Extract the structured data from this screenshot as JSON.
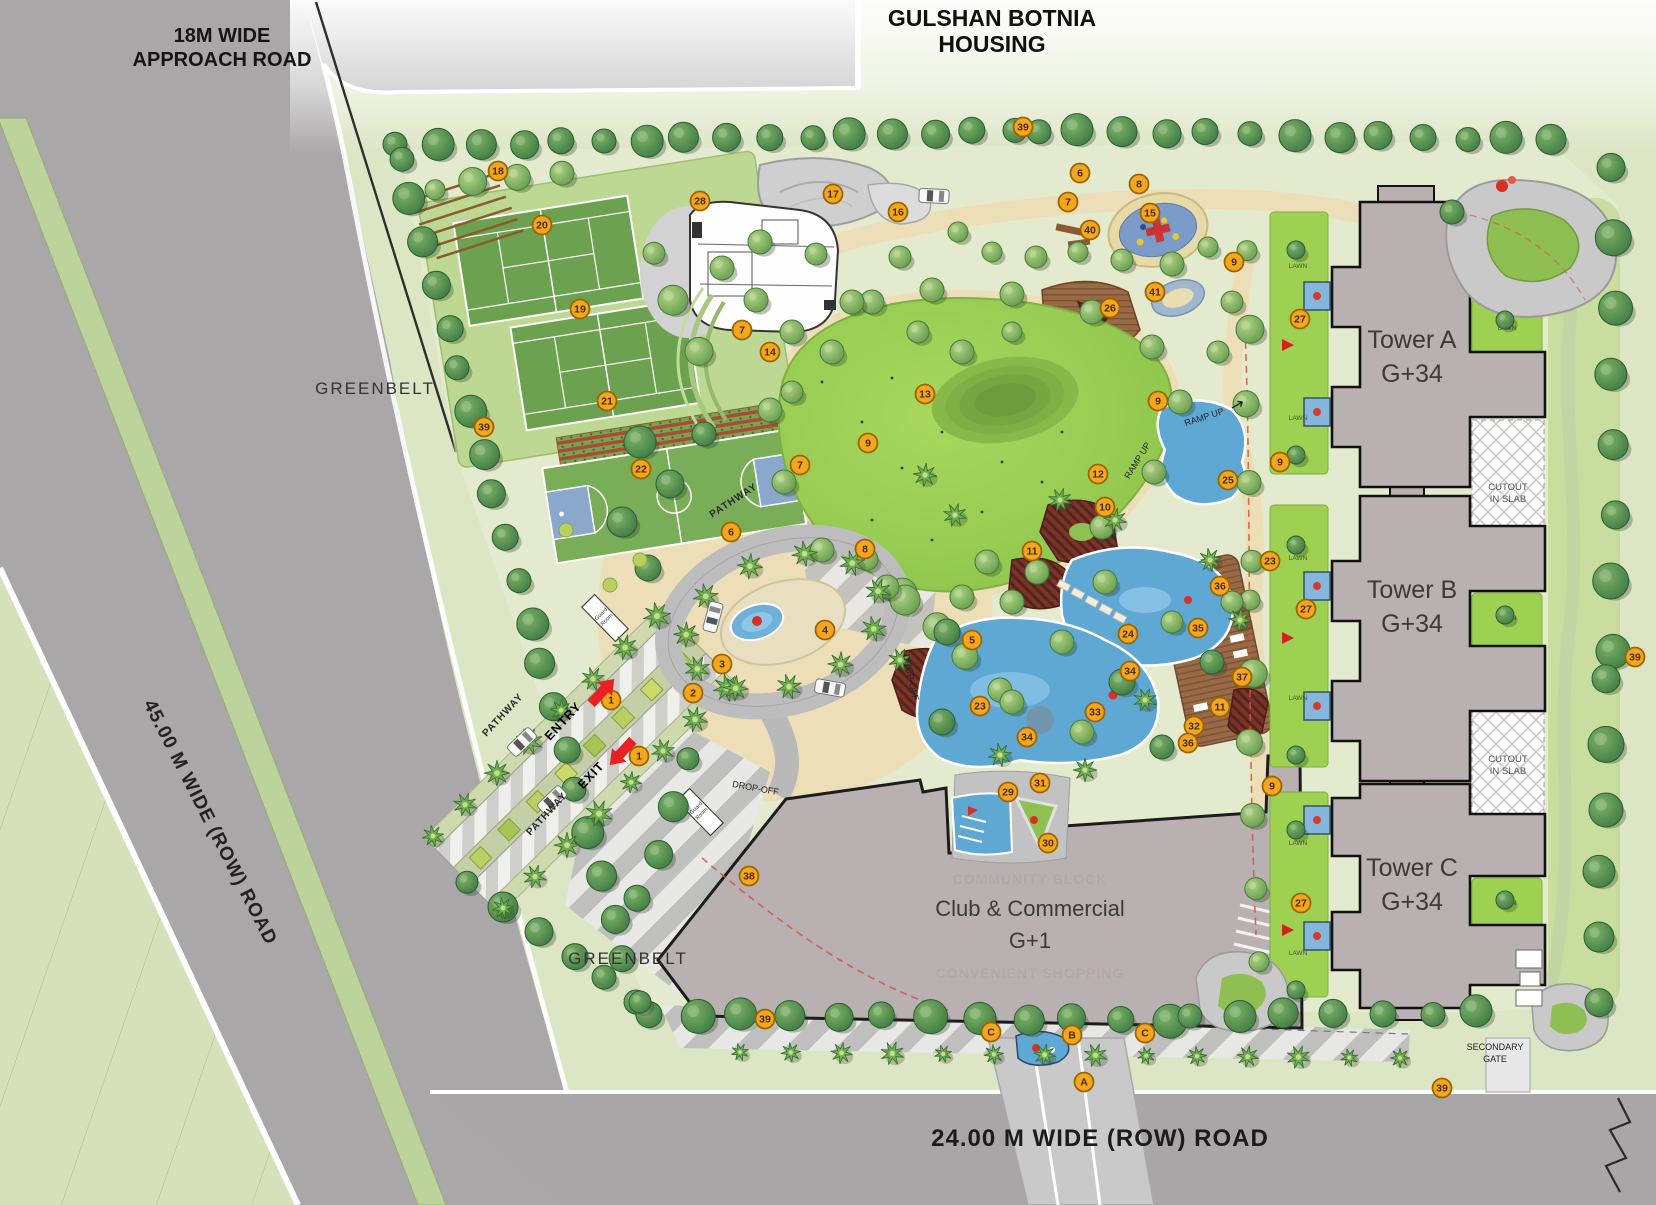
{
  "title": {
    "line1": "GULSHAN BOTNIA",
    "line2": "HOUSING"
  },
  "roads": {
    "approach_l1": "18M WIDE",
    "approach_l2": "APPROACH ROAD",
    "west": "45.00 M  WIDE (ROW) ROAD",
    "south": "24.00 M  WIDE (ROW) ROAD"
  },
  "areas": {
    "greenbelt": "GREENBELT",
    "towers": [
      {
        "name": "Tower A",
        "floors": "G+34"
      },
      {
        "name": "Tower B",
        "floors": "G+34"
      },
      {
        "name": "Tower C",
        "floors": "G+34"
      }
    ],
    "club": {
      "name": "Club & Commercial",
      "floors": "G+1",
      "watermark_top": "COMMUNITY BLOCK",
      "watermark_bottom": "CONVENIENT SHOPPING"
    }
  },
  "labels": {
    "secondary_gate_l1": "SECONDARY",
    "secondary_gate_l2": "GATE",
    "entry": "ENTRY",
    "exit": "EXIT",
    "pathway": "PATHWAY",
    "guard_l1": "Guard",
    "guard_l2": "Room",
    "drop_off": "DROP-OFF",
    "ramp_up": "RAMP UP",
    "cutout_l1": "CUTOUT",
    "cutout_l2": "IN SLAB",
    "lawn": "LAWN"
  },
  "markers": [
    {
      "t": "39",
      "x": 1023,
      "y": 127
    },
    {
      "t": "18",
      "x": 498,
      "y": 171
    },
    {
      "t": "20",
      "x": 542,
      "y": 225
    },
    {
      "t": "28",
      "x": 700,
      "y": 201
    },
    {
      "t": "17",
      "x": 833,
      "y": 194
    },
    {
      "t": "16",
      "x": 898,
      "y": 212
    },
    {
      "t": "7",
      "x": 1068,
      "y": 202
    },
    {
      "t": "6",
      "x": 1080,
      "y": 173
    },
    {
      "t": "8",
      "x": 1139,
      "y": 184
    },
    {
      "t": "15",
      "x": 1150,
      "y": 213
    },
    {
      "t": "40",
      "x": 1090,
      "y": 230
    },
    {
      "t": "9",
      "x": 1234,
      "y": 262
    },
    {
      "t": "41",
      "x": 1155,
      "y": 292
    },
    {
      "t": "26",
      "x": 1110,
      "y": 308
    },
    {
      "t": "19",
      "x": 580,
      "y": 309
    },
    {
      "t": "7",
      "x": 742,
      "y": 330
    },
    {
      "t": "27",
      "x": 1300,
      "y": 319
    },
    {
      "t": "14",
      "x": 770,
      "y": 352
    },
    {
      "t": "13",
      "x": 925,
      "y": 394
    },
    {
      "t": "21",
      "x": 607,
      "y": 401
    },
    {
      "t": "9",
      "x": 1158,
      "y": 401
    },
    {
      "t": "39",
      "x": 484,
      "y": 427
    },
    {
      "t": "9",
      "x": 868,
      "y": 443
    },
    {
      "t": "7",
      "x": 800,
      "y": 465
    },
    {
      "t": "22",
      "x": 641,
      "y": 469
    },
    {
      "t": "9",
      "x": 1280,
      "y": 462
    },
    {
      "t": "12",
      "x": 1098,
      "y": 474
    },
    {
      "t": "25",
      "x": 1228,
      "y": 480
    },
    {
      "t": "10",
      "x": 1105,
      "y": 507
    },
    {
      "t": "6",
      "x": 731,
      "y": 532
    },
    {
      "t": "8",
      "x": 865,
      "y": 549
    },
    {
      "t": "11",
      "x": 1032,
      "y": 551
    },
    {
      "t": "23",
      "x": 1270,
      "y": 561
    },
    {
      "t": "36",
      "x": 1220,
      "y": 586
    },
    {
      "t": "35",
      "x": 1198,
      "y": 628
    },
    {
      "t": "24",
      "x": 1128,
      "y": 634
    },
    {
      "t": "4",
      "x": 825,
      "y": 630
    },
    {
      "t": "5",
      "x": 972,
      "y": 640
    },
    {
      "t": "27",
      "x": 1306,
      "y": 609
    },
    {
      "t": "39",
      "x": 1635,
      "y": 657
    },
    {
      "t": "3",
      "x": 722,
      "y": 664
    },
    {
      "t": "34",
      "x": 1130,
      "y": 671
    },
    {
      "t": "37",
      "x": 1242,
      "y": 677
    },
    {
      "t": "2",
      "x": 693,
      "y": 693
    },
    {
      "t": "1",
      "x": 611,
      "y": 700
    },
    {
      "t": "23",
      "x": 980,
      "y": 706
    },
    {
      "t": "11",
      "x": 1220,
      "y": 707
    },
    {
      "t": "33",
      "x": 1095,
      "y": 712
    },
    {
      "t": "32",
      "x": 1194,
      "y": 726
    },
    {
      "t": "34",
      "x": 1027,
      "y": 737
    },
    {
      "t": "36",
      "x": 1188,
      "y": 743
    },
    {
      "t": "1",
      "x": 639,
      "y": 756
    },
    {
      "t": "29",
      "x": 1008,
      "y": 792
    },
    {
      "t": "31",
      "x": 1040,
      "y": 783
    },
    {
      "t": "9",
      "x": 1272,
      "y": 786
    },
    {
      "t": "30",
      "x": 1048,
      "y": 843
    },
    {
      "t": "38",
      "x": 749,
      "y": 876
    },
    {
      "t": "27",
      "x": 1301,
      "y": 903
    },
    {
      "t": "39",
      "x": 765,
      "y": 1019
    },
    {
      "t": "C",
      "x": 991,
      "y": 1032
    },
    {
      "t": "B",
      "x": 1072,
      "y": 1035
    },
    {
      "t": "C",
      "x": 1145,
      "y": 1033
    },
    {
      "t": "A",
      "x": 1084,
      "y": 1082
    },
    {
      "t": "39",
      "x": 1442,
      "y": 1088
    }
  ],
  "colors": {
    "marker_fill": "#F2A71F",
    "marker_stroke": "#9C6400",
    "road_gray": "#A9A7A8",
    "median_green": "#BCD39B",
    "pool_blue": "#5FA8D3",
    "lawn_green": "#93C94E",
    "building_fill": "#B9B0B1",
    "accent_red": "#E02020",
    "path_tan": "#ECDFB8"
  }
}
